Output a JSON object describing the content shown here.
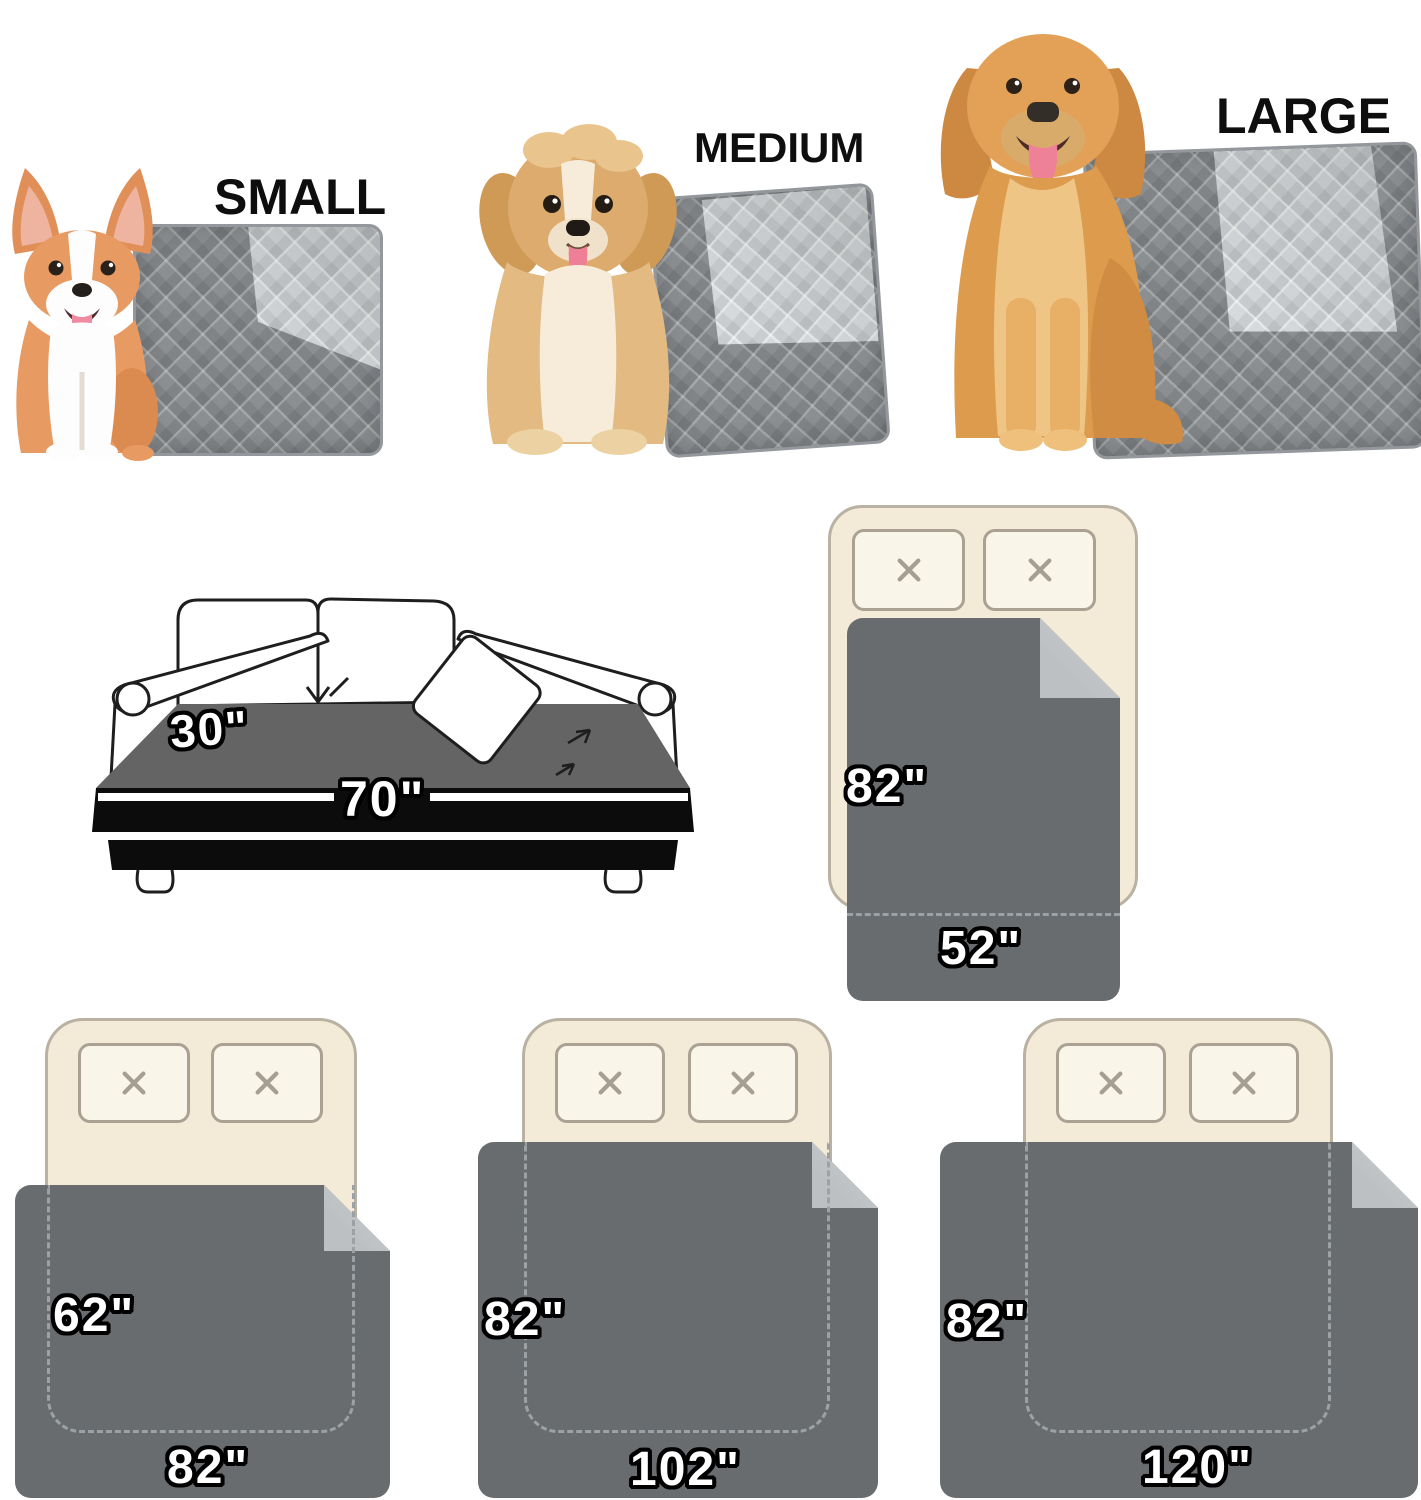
{
  "page": {
    "background": "#ffffff",
    "description": "Waterproof pet blanket size chart"
  },
  "size_options": [
    {
      "label": "SMALL"
    },
    {
      "label": "MEDIUM"
    },
    {
      "label": "LARGE"
    }
  ],
  "sofa_diagram": {
    "depth_label": "30\"",
    "width_label": "70\""
  },
  "bed_diagrams": [
    {
      "length_label": "82\"",
      "width_label": "52\""
    },
    {
      "length_label": "62\"",
      "width_label": "82\""
    },
    {
      "length_label": "82\"",
      "width_label": "102\""
    },
    {
      "length_label": "82\"",
      "width_label": "120\""
    }
  ],
  "icons": {
    "pillow_marker": "cross-icon"
  },
  "colors": {
    "pad_dark": "#8c8f92",
    "pad_light": "#d6dadc",
    "blanket_dark": "#696c6e",
    "blanket_fold": "#bcc0c2",
    "bed_fill": "#f3ead8",
    "bed_border": "#b9b2a2",
    "pillow_fill": "#faf5e9",
    "label_fill": "#ffffff",
    "label_outline": "#000000"
  }
}
